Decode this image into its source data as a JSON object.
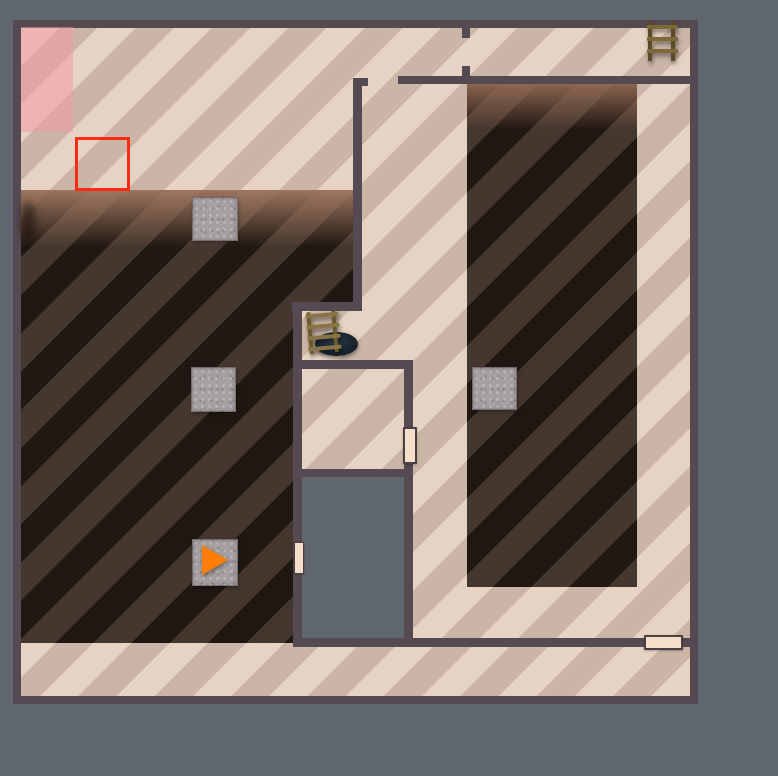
{
  "scene": {
    "description": "Top-down floor plan view of a game level with striped floors, shadowed unlit rooms, crates, ladders, a floor hatch, doors and an orange player direction marker",
    "visible_text": []
  },
  "palette": {
    "bg": "#60666d",
    "wall": "#564a52",
    "floor-a": "#e7d3c3",
    "floor-b": "#cab5a6",
    "shadow-a": "#44372e",
    "shadow-b": "#1f1712",
    "void": "#60666d",
    "door-fill": "#f4dfca",
    "door-border": "#4b3f45",
    "selection-red": "#fb2a12",
    "pink-overlay": "rgba(246,150,163,0.5)",
    "player-orange": "#fc7e06",
    "crate": "#a7a0a2",
    "ladder-rail": "#5c4a24",
    "ladder-rung": "#7d6839",
    "ladder2-rail": "#6b5a2e",
    "ladder2-rung": "#8a7444"
  },
  "map": {
    "bounds": [
      13,
      20,
      685,
      684
    ],
    "floor_origin": [
      8,
      8
    ],
    "floor_size": [
      669,
      668
    ],
    "elements": [
      {
        "kind": "floor",
        "name": "floor-striped",
        "interactable": true,
        "rect": [
          8,
          8,
          669,
          668
        ]
      },
      {
        "kind": "pink",
        "name": "pink-zone",
        "interactable": false,
        "rect": [
          8,
          7,
          52,
          105
        ]
      },
      {
        "kind": "shadow",
        "name": "shadow-region-left",
        "interactable": false,
        "rect": [
          8,
          170,
          332,
          453
        ],
        "clip": [
          [
            0,
            0
          ],
          [
            332,
            0
          ],
          [
            332,
            112
          ],
          [
            272,
            112
          ],
          [
            272,
            453
          ],
          [
            0,
            453
          ]
        ],
        "fade": {
          "height": 58,
          "color": "rgba(163,121,97,0.95)"
        }
      },
      {
        "kind": "shadow",
        "name": "shadow-region-right",
        "interactable": false,
        "rect": [
          454,
          64,
          170,
          503
        ],
        "fade": {
          "height": 46,
          "color": "rgba(150,108,85,0.9)"
        }
      },
      {
        "kind": "void",
        "name": "void-area",
        "interactable": false,
        "rect": [
          289,
          457,
          102,
          161
        ]
      },
      {
        "kind": "smudge",
        "name": "wall-shadow-smudge",
        "interactable": false,
        "rect": [
          8,
          182,
          14,
          40
        ]
      },
      {
        "kind": "selection",
        "name": "selection-box",
        "interactable": false,
        "rect": [
          62,
          117,
          55,
          54
        ]
      },
      {
        "kind": "hole",
        "name": "floor-hatch-hole",
        "interactable": true,
        "rect": [
          302,
          312,
          43,
          24
        ]
      },
      {
        "kind": "ladder",
        "name": "ladder-icon-hatch",
        "interactable": true,
        "rect": [
          294,
          291,
          34,
          42
        ],
        "rungs": [
          2,
          13,
          24,
          35
        ],
        "rotate": -5,
        "variant": 2
      },
      {
        "kind": "wall",
        "name": "wall-corridor-left",
        "interactable": false,
        "rect": [
          340,
          58,
          9,
          233
        ]
      },
      {
        "kind": "wall",
        "name": "wall-corridor-left-lip",
        "interactable": false,
        "rect": [
          340,
          58,
          15,
          8
        ]
      },
      {
        "kind": "wall",
        "name": "wall-top-room-bottom",
        "interactable": false,
        "rect": [
          385,
          56,
          292,
          8
        ]
      },
      {
        "kind": "wall",
        "name": "wall-top-doorframe-upper",
        "interactable": false,
        "rect": [
          449,
          7,
          8,
          11
        ]
      },
      {
        "kind": "wall",
        "name": "wall-top-doorframe-lower",
        "interactable": false,
        "rect": [
          449,
          46,
          8,
          10
        ]
      },
      {
        "kind": "wall",
        "name": "wall-alcove-top",
        "interactable": false,
        "rect": [
          279,
          282,
          70,
          9
        ]
      },
      {
        "kind": "wall",
        "name": "wall-mid-vertical-left",
        "interactable": false,
        "rect": [
          280,
          282,
          9,
          345
        ]
      },
      {
        "kind": "wall",
        "name": "wall-alcove-bottom",
        "interactable": false,
        "rect": [
          289,
          340,
          111,
          9
        ]
      },
      {
        "kind": "wall",
        "name": "wall-mid-vertical-right",
        "interactable": false,
        "rect": [
          391,
          340,
          9,
          287
        ]
      },
      {
        "kind": "wall",
        "name": "wall-small-room-bottom",
        "interactable": false,
        "rect": [
          289,
          449,
          107,
          8
        ]
      },
      {
        "kind": "wall",
        "name": "wall-bottom-corridor-top",
        "interactable": false,
        "rect": [
          280,
          618,
          397,
          9
        ]
      },
      {
        "kind": "ladder",
        "name": "ladder-icon-top-right",
        "interactable": true,
        "rect": [
          634,
          1,
          32,
          40
        ],
        "rungs": [
          4,
          16,
          28
        ],
        "rotate": 0,
        "variant": 1
      },
      {
        "kind": "door",
        "name": "door-small-room-east",
        "interactable": true,
        "rect": [
          390,
          407,
          14,
          37
        ]
      },
      {
        "kind": "door",
        "name": "door-void-west",
        "interactable": true,
        "rect": [
          281,
          522,
          10,
          32
        ],
        "thin": true
      },
      {
        "kind": "door",
        "name": "door-bottom-corridor",
        "interactable": true,
        "rect": [
          631,
          615,
          39,
          15
        ]
      },
      {
        "kind": "crate",
        "name": "crate-top",
        "interactable": true,
        "rect": [
          179,
          177,
          46,
          44
        ]
      },
      {
        "kind": "crate",
        "name": "crate-mid-left",
        "interactable": true,
        "rect": [
          178,
          347,
          45,
          45
        ]
      },
      {
        "kind": "crate",
        "name": "crate-mid-right",
        "interactable": true,
        "rect": [
          459,
          347,
          45,
          43
        ]
      },
      {
        "kind": "crate",
        "name": "crate-player",
        "interactable": true,
        "rect": [
          179,
          519,
          46,
          47
        ]
      },
      {
        "kind": "player",
        "name": "player-marker",
        "interactable": true,
        "rect": [
          189,
          525,
          26,
          30
        ],
        "direction": "right"
      }
    ]
  }
}
